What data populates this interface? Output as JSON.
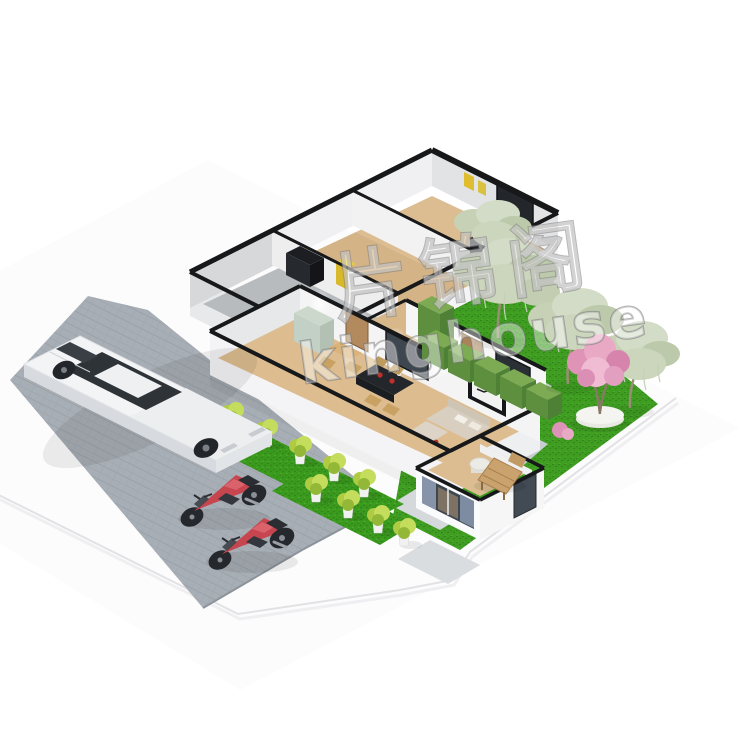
{
  "meta": {
    "description": "3D isometric product render of a prefab flat-pack container house floor plan with cutaway roof, landscaped garden, driveway with white sports car and two red motorcycles",
    "background": "#ffffff"
  },
  "watermark": {
    "line1": "片锦阁",
    "line2": "kinghouse"
  },
  "palette": {
    "garden_grass": "#3f9e22",
    "strip_grass": "#3a9a1e",
    "grass_dark_line": "#2e7f15",
    "grass_light_line": "#55b531",
    "pavement": "#a8aeb5",
    "pavement_line": "#9aa1a9",
    "walkway": "#d6d9dc",
    "garden_path": "#ccd0d4",
    "wall_white": "#f4f4f6",
    "wall_shade": "#e8e9eb",
    "trim_black": "#17181a",
    "floor_wood": "#dcbd92",
    "floor_wood_dark": "#d4b386",
    "floor_gray": "#b8bbbe",
    "door_wood": "#b28a5e",
    "cabinet_mint": "#c3d0c5",
    "sofa_beige": "#d8cfc1",
    "table_dark": "#23262b",
    "plate_red": "#c03028",
    "curtain_slate": "#7e8ca2",
    "curtain_slate_light": "#8793a8",
    "glass_dark": "#3e4650",
    "willow_sage": "#ccd6bd",
    "blossom_pink": "#e9a9c5",
    "hedge_green": "#7cab53",
    "hedge_green_dark": "#5d8f3e",
    "car_white": "#f3f4f6",
    "moto_red": "#c6454f",
    "accent_yellow": "#e0bc2f",
    "stone_white": "#f4f4f0",
    "lounger_wood": "#c9a26d"
  },
  "scene": {
    "house_rooms": [
      "bedroom-right",
      "bedroom-middle",
      "empty-gray-room",
      "hallway",
      "kitchen-dining",
      "living-room",
      "bathroom"
    ],
    "vehicles": {
      "sports_car": 1,
      "motorcycles": 2
    },
    "landscaping": {
      "potted_shrubs": 9,
      "willow_trees": 4,
      "blossom_tree": 1,
      "hedge_boxes": 6,
      "wood_lounger": 1
    }
  }
}
